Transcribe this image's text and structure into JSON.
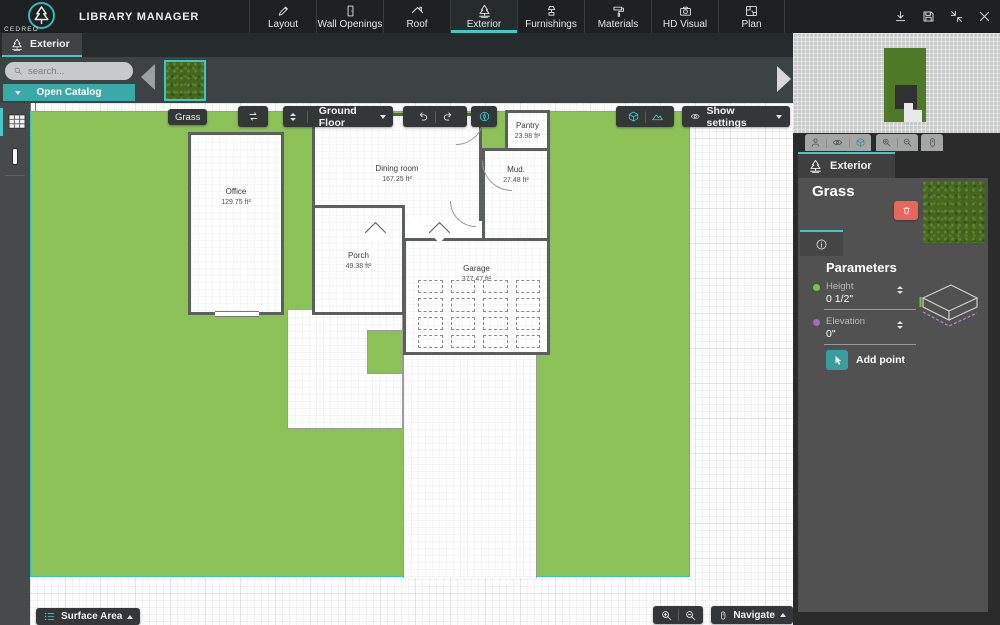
{
  "topbar": {
    "logo_text": "CEDREO",
    "title": "LIBRARY MANAGER",
    "tabs": [
      {
        "label": "Layout",
        "icon": "pencil-icon",
        "active": false
      },
      {
        "label": "Wall Openings",
        "icon": "door-icon",
        "active": false
      },
      {
        "label": "Roof",
        "icon": "roof-icon",
        "active": false
      },
      {
        "label": "Exterior",
        "icon": "tree-icon",
        "active": true
      },
      {
        "label": "Furnishings",
        "icon": "furniture-icon",
        "active": false
      },
      {
        "label": "Materials",
        "icon": "paint-roller-icon",
        "active": false
      },
      {
        "label": "HD Visual",
        "icon": "camera-icon",
        "active": false
      },
      {
        "label": "Plan",
        "icon": "plan-icon",
        "active": false
      }
    ],
    "action_icons": [
      "download-icon",
      "save-icon",
      "collapse-icon",
      "close-icon"
    ]
  },
  "catalog": {
    "tab_label": "Exterior",
    "search_placeholder": "search...",
    "open_catalog_label": "Open Catalog",
    "selected_item": "Grass"
  },
  "canvas": {
    "toolbar": {
      "selection_label": "Grass",
      "floor_label": "Ground Floor",
      "show_settings_label": "Show settings",
      "icons": [
        "repeat-icon",
        "undo-icon",
        "redo-icon",
        "compass-icon",
        "cube-icon",
        "terrain-icon",
        "eye-icon"
      ]
    },
    "rooms": [
      {
        "name": "Office",
        "area": "129.75 ft²"
      },
      {
        "name": "Porch",
        "area": "49.38 ft²"
      },
      {
        "name": "Dining room",
        "area": "167.25 ft²"
      },
      {
        "name": "Pantry",
        "area": "23.98 ft²"
      },
      {
        "name": "Mud.",
        "area": "27.48 ft²"
      },
      {
        "name": "Garage",
        "area": "377.47 ft²"
      }
    ],
    "bottom": {
      "surface_area_label": "Surface Area",
      "navigate_label": "Navigate",
      "icons": [
        "list-icon",
        "zoom-in-icon",
        "zoom-out-icon",
        "mouse-icon"
      ]
    }
  },
  "panel": {
    "tab_label": "Exterior",
    "item_title": "Grass",
    "preview_icons": [
      "person-icon",
      "eye-icon",
      "cube-icon",
      "zoom-in-icon",
      "zoom-out-icon",
      "hand-icon"
    ],
    "parameters": {
      "title": "Parameters",
      "height_label": "Height",
      "height_value": "0 1/2\"",
      "elevation_label": "Elevation",
      "elevation_value": "0\"",
      "add_point_label": "Add point"
    }
  },
  "colors": {
    "accent_teal": "#45c8c8",
    "grass_green": "#8cc158",
    "delete_red": "#e8675c",
    "height_dot": "#7cc14e",
    "elevation_dot": "#a569bd"
  }
}
